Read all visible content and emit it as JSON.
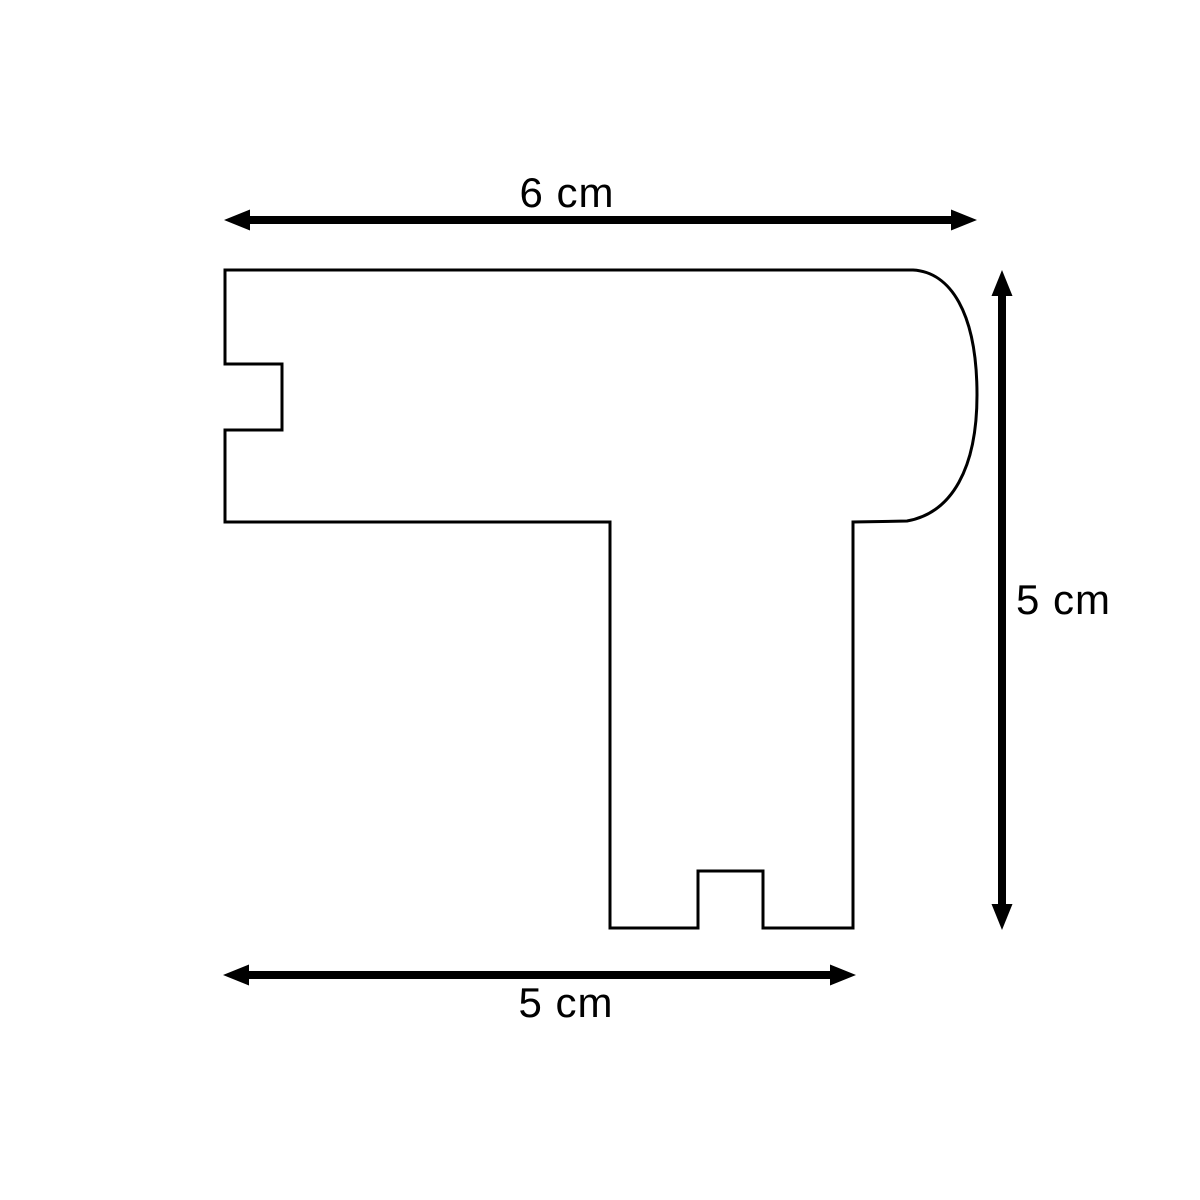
{
  "page": {
    "background_color": "#ffffff"
  },
  "diagram": {
    "line_color": "#000000",
    "dimensions": {
      "top": {
        "label": "6 cm",
        "value": 6,
        "unit": "cm",
        "orientation": "horizontal"
      },
      "right": {
        "label": "5 cm",
        "value": 5,
        "unit": "cm",
        "orientation": "vertical"
      },
      "bottom": {
        "label": "5 cm",
        "value": 5,
        "unit": "cm",
        "orientation": "horizontal"
      }
    }
  }
}
